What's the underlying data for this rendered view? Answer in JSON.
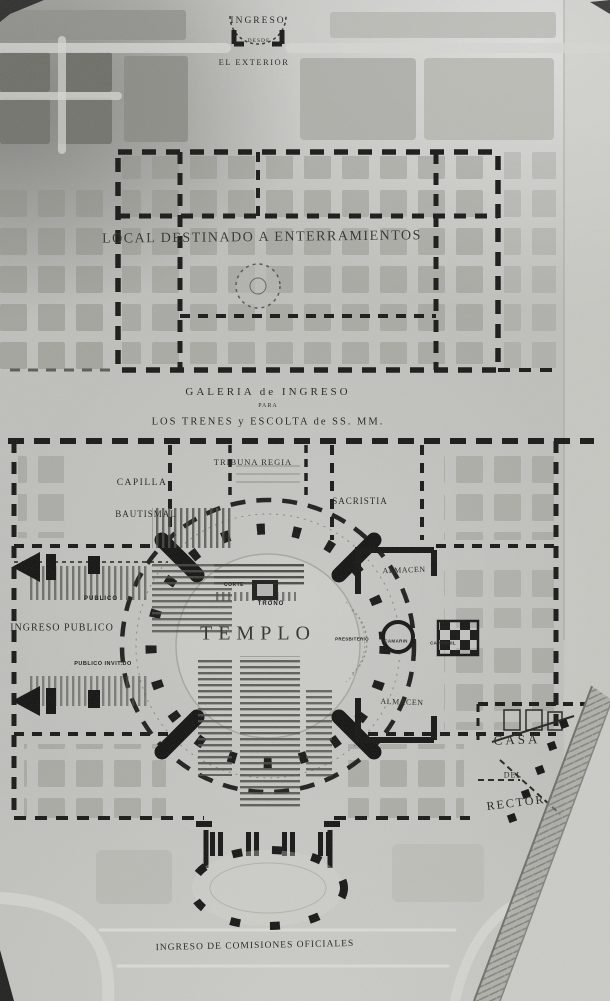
{
  "photo": {
    "kind": "architectural-site-plan",
    "colors": {
      "paper": "#bfbfbb",
      "ink": "#161614",
      "garden": "#8e8e87",
      "road": "#d6d6d2"
    },
    "labels": {
      "entrance_top_1": "INGRESO",
      "entrance_top_2": "DESDE",
      "entrance_top_3": "EL EXTERIOR",
      "cemetery": "LOCAL DESTINADO A ENTERRAMIENTOS",
      "gallery_1": "GALERIA de INGRESO",
      "gallery_2": "PARA",
      "gallery_3": "LOS TRENES y ESCOLTA de SS. MM.",
      "tribuna": "TRIBUNA REGIA",
      "capilla": "CAPILLA",
      "bautismal": "BAUTISMAL",
      "sacristia": "SACRISTIA",
      "publico": "PUBLICO",
      "ingreso_publico": "INGRESO PUBLICO",
      "publico_invitado": "PUBLICO INVIT.DO",
      "corte": "CORTE",
      "trono": "TRONO",
      "templo": "TEMPLO",
      "almacen_norte": "ALMACEN",
      "presbiterio": "PRESBITERIO",
      "camarin": "CAMARIN",
      "campanil": "CAMPANIL",
      "almacen_sur": "ALMACEN",
      "casa": "CASA",
      "del": "DEL",
      "rector": "RECTOR",
      "ingreso_comisiones": "INGRESO DE COMISIONES OFICIALES"
    }
  }
}
